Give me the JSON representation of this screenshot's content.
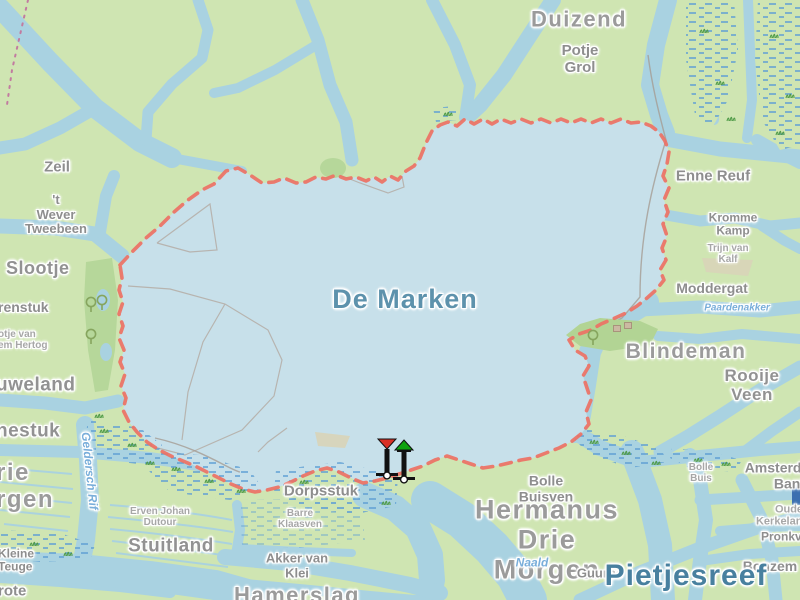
{
  "map": {
    "title": "De Marken",
    "type": "topographic-water-map",
    "colors": {
      "land": "#cfe5b2",
      "water_channel": "#a9d2e1",
      "lake": "#c7e0ea",
      "forest": "#b6d79a",
      "island_green": "#b2d494",
      "marsh_dash": "#5f9fd4",
      "route_dashed": "#ed7164",
      "parcel_line": "#b2a69c",
      "boundary_dots": "#c27ba0",
      "grass_tuft": "#4f9b47",
      "area_label": "#9b9b9b",
      "water_label": "#79aeda",
      "lake_label": "#5d92ac",
      "plate_blue": "#3b6fb0"
    },
    "labels": [
      {
        "id": "duizend",
        "text": "Duizend",
        "x": 579,
        "y": 20,
        "cls": "area-xl",
        "size": 22
      },
      {
        "id": "potje-grol",
        "text": "Potje\nGrol",
        "x": 580,
        "y": 60,
        "cls": "area-md",
        "size": 15
      },
      {
        "id": "zeil",
        "text": "Zeil",
        "x": 57,
        "y": 168,
        "cls": "area-md",
        "size": 15
      },
      {
        "id": "t-wever-tweebeen",
        "text": "'t\nWever\nTweebeen",
        "x": 56,
        "y": 215,
        "cls": "area-md",
        "size": 13
      },
      {
        "id": "slootje",
        "text": "Slootje",
        "x": 6,
        "y": 268,
        "cls": "area-lg",
        "size": 18,
        "align": "left"
      },
      {
        "id": "renstuk",
        "text": "renstuk",
        "x": -2,
        "y": 308,
        "cls": "area-md",
        "size": 14,
        "align": "left"
      },
      {
        "id": "otje-van-em-hertog",
        "text": "otje van\nem Hertog",
        "x": -2,
        "y": 340,
        "cls": "area-sm",
        "size": 10,
        "align": "left"
      },
      {
        "id": "uweland",
        "text": "uweland",
        "x": -4,
        "y": 385,
        "cls": "area-lg",
        "size": 19,
        "align": "left"
      },
      {
        "id": "nestuk",
        "text": "nestuk",
        "x": -4,
        "y": 431,
        "cls": "area-lg",
        "size": 19,
        "align": "left"
      },
      {
        "id": "rie-rgen",
        "text": "rie\nrgen",
        "x": -4,
        "y": 487,
        "cls": "area-xl",
        "size": 24,
        "align": "left"
      },
      {
        "id": "geldersch-rif",
        "text": "Geldersch Rif",
        "x": 89,
        "y": 471,
        "cls": "water-sm",
        "size": 12,
        "rot": 84
      },
      {
        "id": "kleine-teuge",
        "text": "Kleine\nTeuge",
        "x": -2,
        "y": 561,
        "cls": "area-md",
        "size": 12,
        "align": "left"
      },
      {
        "id": "grote",
        "text": "rote",
        "x": -2,
        "y": 592,
        "cls": "area-md",
        "size": 15,
        "align": "left"
      },
      {
        "id": "erven-johan-dutour",
        "text": "Erven Johan\nDutour",
        "x": 160,
        "y": 517,
        "cls": "area-sm",
        "size": 10
      },
      {
        "id": "stuitland",
        "text": "Stuitland",
        "x": 171,
        "y": 546,
        "cls": "area-lg",
        "size": 19
      },
      {
        "id": "barre-klaasven",
        "text": "Barre\nKlaasven",
        "x": 300,
        "y": 519,
        "cls": "area-sm",
        "size": 10
      },
      {
        "id": "dorpsstuk",
        "text": "Dorpsstuk",
        "x": 321,
        "y": 492,
        "cls": "area-md",
        "size": 15
      },
      {
        "id": "akker-van-klei",
        "text": "Akker van\nKlei",
        "x": 297,
        "y": 566,
        "cls": "area-md",
        "size": 13
      },
      {
        "id": "hamerslag",
        "text": "Hamerslag",
        "x": 297,
        "y": 596,
        "cls": "area-xl",
        "size": 22
      },
      {
        "id": "de-marken",
        "text": "De Marken",
        "x": 405,
        "y": 299,
        "cls": "lake-lg",
        "size": 27
      },
      {
        "id": "enne-reuf",
        "text": "Enne Reuf",
        "x": 713,
        "y": 177,
        "cls": "area-md",
        "size": 15
      },
      {
        "id": "kromme-kamp",
        "text": "Kromme\nKamp",
        "x": 733,
        "y": 225,
        "cls": "area-md",
        "size": 12
      },
      {
        "id": "trijn-van-kalf",
        "text": "Trijn van\nKalf",
        "x": 728,
        "y": 254,
        "cls": "area-sm",
        "size": 10
      },
      {
        "id": "moddergat",
        "text": "Moddergat",
        "x": 712,
        "y": 289,
        "cls": "area-md",
        "size": 14
      },
      {
        "id": "paardenakker",
        "text": "Paardenakker",
        "x": 737,
        "y": 308,
        "cls": "water-sm",
        "size": 10
      },
      {
        "id": "blindeman",
        "text": "Blindeman",
        "x": 686,
        "y": 352,
        "cls": "area-xl",
        "size": 21
      },
      {
        "id": "rooije-veen",
        "text": "Rooije\nVeen",
        "x": 752,
        "y": 385,
        "cls": "area-lg",
        "size": 17
      },
      {
        "id": "bolle-buis",
        "text": "Bolle\nBuis",
        "x": 701,
        "y": 473,
        "cls": "area-sm",
        "size": 10
      },
      {
        "id": "bolle-buisven",
        "text": "Bolle\nBuisven",
        "x": 546,
        "y": 489,
        "cls": "area-md",
        "size": 14
      },
      {
        "id": "hermanus-drie-morgen",
        "text": "Hermanus\nDrie\nMorgen",
        "x": 547,
        "y": 540,
        "cls": "area-xl",
        "size": 27
      },
      {
        "id": "naald",
        "text": "Naald",
        "x": 532,
        "y": 563,
        "cls": "water-sm",
        "size": 12
      },
      {
        "id": "guurbe",
        "text": "Guurbe",
        "x": 600,
        "y": 574,
        "cls": "area-md",
        "size": 13
      },
      {
        "id": "bonzem",
        "text": "Bonzem",
        "x": 770,
        "y": 567,
        "cls": "area-md",
        "size": 14
      },
      {
        "id": "amsterdamse-bank",
        "text": "Amsterdamse\nBank",
        "x": 791,
        "y": 476,
        "cls": "area-md",
        "size": 14
      },
      {
        "id": "oude-kerkelanden",
        "text": "Oude\nKerkelanden",
        "x": 789,
        "y": 516,
        "cls": "area-sm",
        "size": 11
      },
      {
        "id": "pronkvennen",
        "text": "Pronkvennen",
        "x": 799,
        "y": 537,
        "cls": "area-md",
        "size": 12
      },
      {
        "id": "pietjesreef",
        "text": "Pietjesreef",
        "x": 686,
        "y": 576,
        "cls": "water-xl",
        "size": 30
      }
    ],
    "icons": [
      {
        "name": "port-beacon-icon",
        "type": "port-beacon",
        "x": 375,
        "y": 437
      },
      {
        "name": "starboard-beacon-icon",
        "type": "starboard-beacon",
        "x": 392,
        "y": 439
      },
      {
        "name": "tree-icon",
        "type": "tree",
        "x": 84,
        "y": 296
      },
      {
        "name": "tree-icon",
        "type": "tree",
        "x": 95,
        "y": 294
      },
      {
        "name": "tree-icon",
        "type": "tree",
        "x": 84,
        "y": 328
      },
      {
        "name": "tree-icon",
        "type": "tree",
        "x": 586,
        "y": 329
      },
      {
        "name": "building-icon",
        "type": "building",
        "x": 613,
        "y": 319
      },
      {
        "name": "building-icon",
        "type": "building",
        "x": 624,
        "y": 316
      },
      {
        "name": "blue-plate",
        "type": "blue-plate",
        "x": 792,
        "y": 483
      }
    ]
  }
}
